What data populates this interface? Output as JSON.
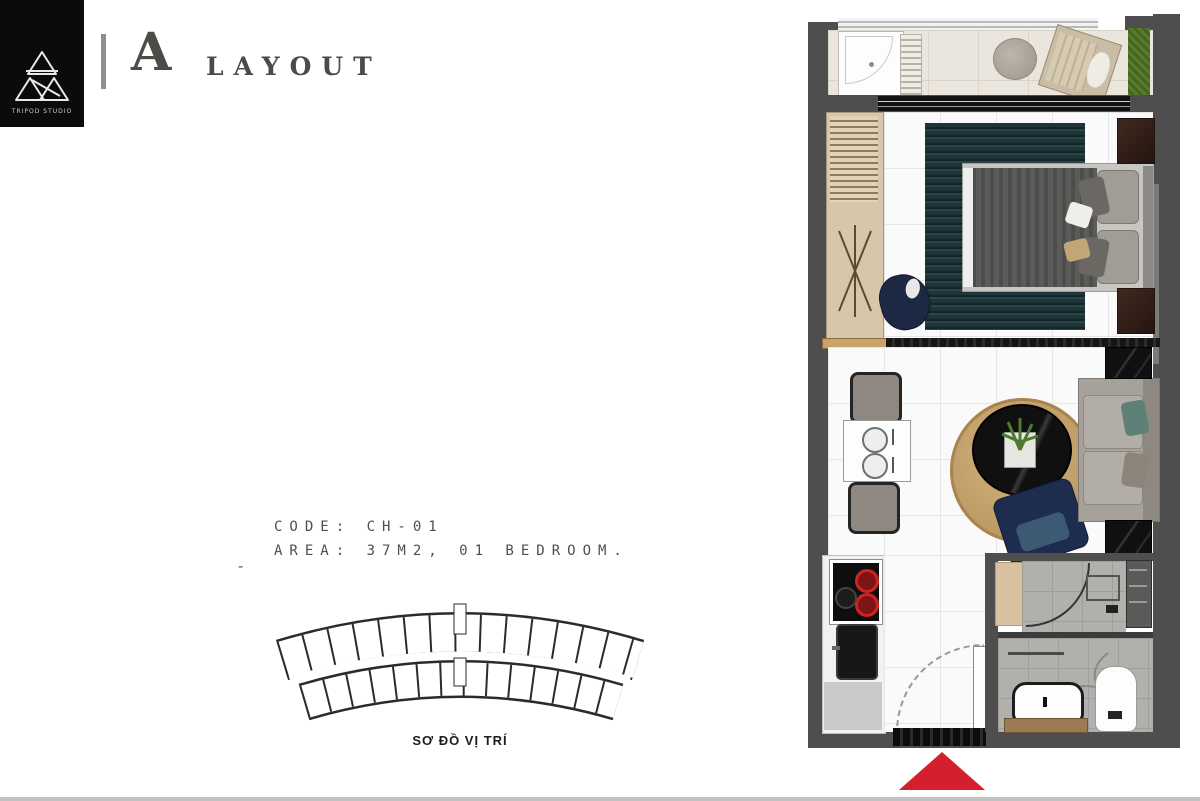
{
  "brand": {
    "studio_name": "TRIPOD STUDIO"
  },
  "header": {
    "title_letter": "A",
    "title_rest": "LAYOUT"
  },
  "unit_info": {
    "code_line": "CODE: CH-01",
    "area_line": "AREA: 37M2, 01 BEDROOM.",
    "dash": "-"
  },
  "location_map": {
    "caption": "SƠ ĐỒ VỊ TRÍ"
  },
  "colors": {
    "accent_red": "#d4202c",
    "wall_dark": "#4e4e4e",
    "ink": "#4b4b48",
    "logo_background": "#0b0b0b"
  }
}
